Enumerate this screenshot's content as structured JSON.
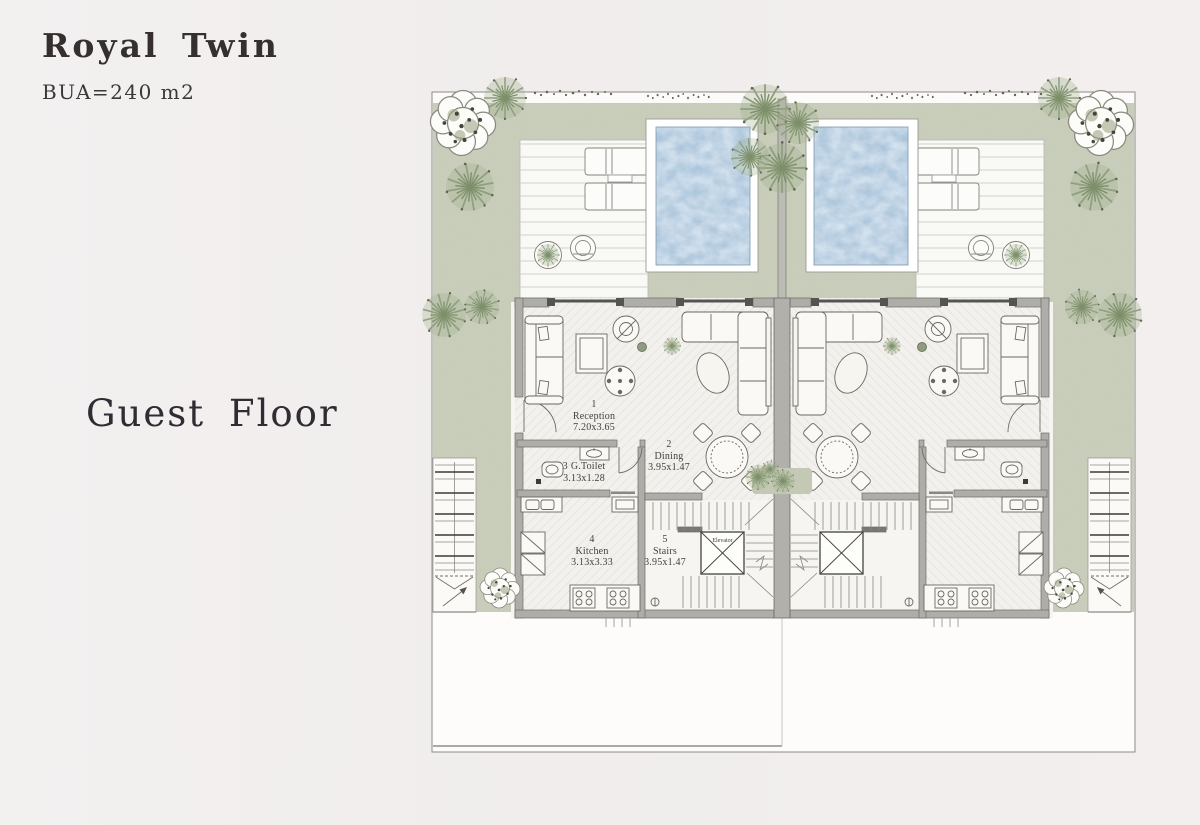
{
  "page": {
    "title": "Royal Twin",
    "subtitle": "BUA=240 m2",
    "floor_label": "Guest Floor"
  },
  "plan": {
    "rooms": [
      {
        "number": "1",
        "name": "Reception",
        "dims": "7.20x3.65"
      },
      {
        "number": "2",
        "name": "Dining",
        "dims": "3.95x1.47"
      },
      {
        "number": "3",
        "name": "G.Toilet",
        "dims": "3.13x1.28"
      },
      {
        "number": "4",
        "name": "Kitchen",
        "dims": "3.13x3.33"
      },
      {
        "number": "5",
        "name": "Stairs",
        "dims": "3.95x1.47"
      }
    ],
    "elevator_label": "Elevator",
    "colors": {
      "page_bg": "#f1eeee",
      "garden_green": "#c9cdbb",
      "pool_blue": "#a2bed6",
      "wall_gray": "#aeada8",
      "deck": "#f9f9f6",
      "text_dark": "#362f2f"
    }
  }
}
